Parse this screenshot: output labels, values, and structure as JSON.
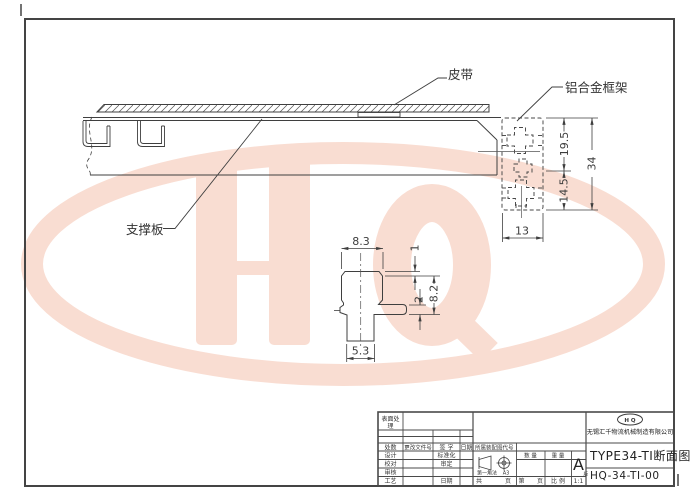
{
  "watermark": {
    "text": "HQ",
    "color": "#f9ddd2"
  },
  "labels": {
    "belt": "皮带",
    "frame": "铝合金框架",
    "plate": "支撑板"
  },
  "dims": {
    "frame_upper": "19.5",
    "frame_total": "34",
    "frame_lower": "14.5",
    "frame_width": "13",
    "head_width": "8.3",
    "top_offset": "1",
    "slot_height": "8.2",
    "arm_thick": "2",
    "stem_width": "5.3"
  },
  "title_block": {
    "surface_line1": "表面处",
    "surface_line2": "理",
    "rev_count": "处数",
    "rev_doc": "更改文件号",
    "rev_sign": "签 字",
    "rev_date": "日期",
    "f_design": "设计",
    "f_check": "校对",
    "f_audit": "审核",
    "f_process": "工艺",
    "f_std": "标准化",
    "f_approve": "审定",
    "f_date": "日期",
    "assembly_code": "所属装配图代号",
    "qty": "数 量",
    "weight": "重 量",
    "projection": "第一角法",
    "sheet": "A3",
    "rev_letter": "A",
    "rev_ver": "版",
    "pg_total": "共",
    "pg_unit1": "页",
    "pg_no": "第",
    "pg_unit2": "页",
    "scale_label": "比 例",
    "scale": "1:1",
    "logo": "H Q",
    "company": "无锡汇千物流机械制造有限公司",
    "title": "TYPE34-TI断面图",
    "code": "HQ-34-TI-00"
  }
}
